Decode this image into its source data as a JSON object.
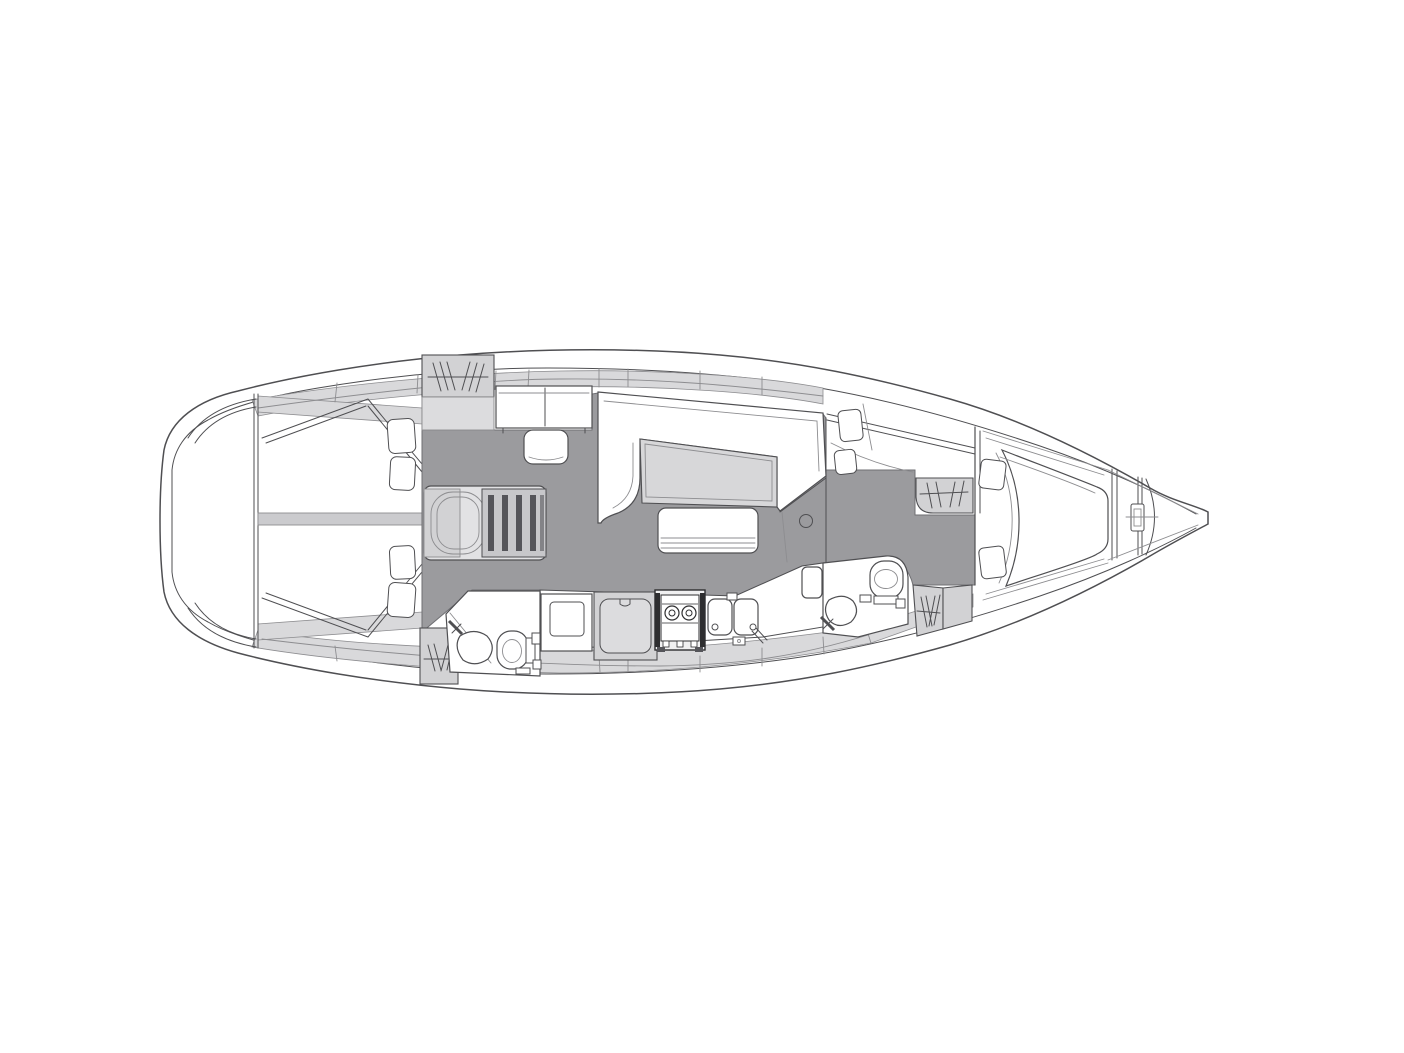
{
  "image": {
    "type": "sailboat-interior-floor-plan",
    "orientation": "bow-right",
    "background": "#ffffff"
  },
  "colors": {
    "outline": "#4f4f52",
    "outline_light": "#8d8d90",
    "floor": "#9b9b9e",
    "furniture": "#d2d2d4",
    "deck": "#d9d9db",
    "table": "#d7d7d9",
    "steps": "#c7c7ca",
    "stove_dark": "#2e2e30",
    "white": "#ffffff"
  },
  "fixtures": [
    "aft-double-berth-port",
    "aft-double-berth-starboard",
    "pillows",
    "hanging-locker",
    "nav-desk",
    "nav-seat",
    "companionway-steps",
    "l-settee",
    "saloon-table",
    "bench-seat",
    "mast-post",
    "galley-fridge",
    "top-loading-cooler",
    "two-burner-stove",
    "double-sink",
    "aft-head-toilet",
    "aft-head-sink",
    "forward-head-toilet",
    "forward-head-sink",
    "side-berth",
    "v-berth",
    "anchor-locker"
  ]
}
